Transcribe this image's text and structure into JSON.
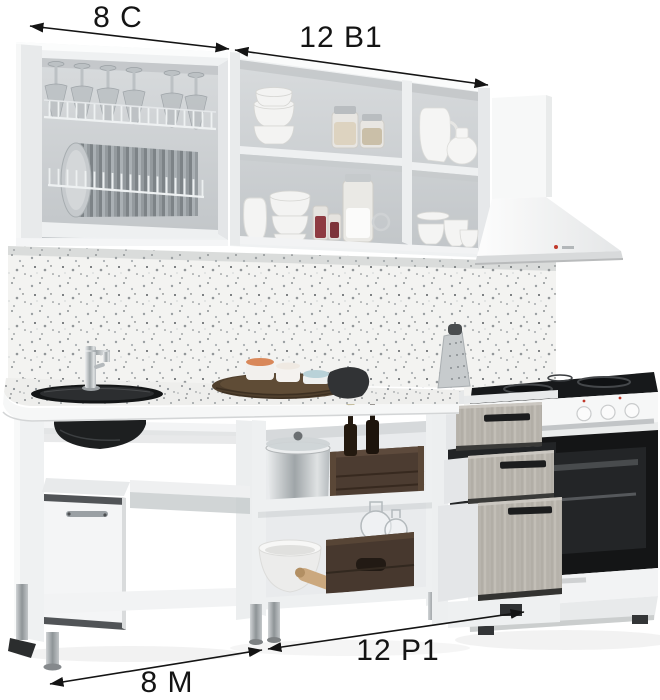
{
  "annotations": {
    "wall_left": {
      "label": "8 С"
    },
    "wall_middle": {
      "label": "12 В1"
    },
    "base_left": {
      "label": "8 М"
    },
    "base_right": {
      "label": "12 Р1"
    }
  },
  "palette": {
    "background": "#ffffff",
    "annotation_text": "#141414",
    "cabinet_white": "#f0f1f2",
    "cabinet_interior": "#cfd3d5",
    "backsplash_speckle": "#f3f3f1",
    "countertop_speckle": "#efefed",
    "sink_black": "#161819",
    "hood_white": "#f6f7f7",
    "drawer_ash_wood": "#b8b4ad",
    "handle_black": "#1c1d1e",
    "crate_wood_brown": "#4a3a2f",
    "oven_door_black": "#141516",
    "stove_body_white": "#f6f7f7",
    "metal_silver": "#9fa5a8"
  }
}
